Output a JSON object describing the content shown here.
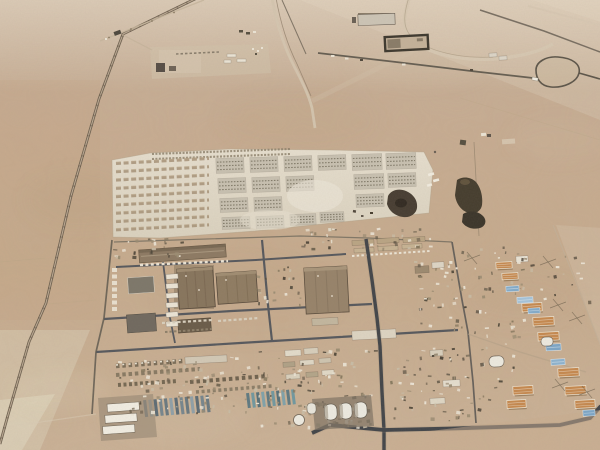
{
  "meta": {
    "type": "aerial-photograph",
    "subject": "Oblique aerial view of a large desert military base: tent city grid, warehouse district, vehicle and container yards, dome tents and rows of sand-colored barracks in flat tan desert",
    "environment": "hazy daylight over flat sandy desert",
    "visible_text": "none"
  },
  "palette": {
    "desert_top": "#c6b09a",
    "desert_mid": "#c8ad90",
    "desert_low": "#cbb297",
    "desert_light_wash": "#dccfb8",
    "tent_ground_a": "#e8e1d2",
    "tent_ground_b": "#dcd4c2",
    "tent_block": "#c8c1b1",
    "tent_speckle": "#77705f",
    "tent_row_brown": "#9b8468",
    "road_dark": "#43454a",
    "road_mid": "#56585d",
    "road_pale": "#d7c8b2",
    "track_tan": "#b3a186",
    "warehouse_roof": "#87745d",
    "warehouse_roof_light": "#97836a",
    "warehouse_long": "#8d7a63",
    "building_gray": "#7d776b",
    "building_dark": "#6b5c4a",
    "hut_white": "#ece5d6",
    "barracks_tan": "#c6894f",
    "barracks_trim": "#f0e7d5",
    "tarp_blue": "#83accb",
    "container_steel": "#6a7980",
    "container_teal": "#5e7a82",
    "scrap_dark": "#443c2f",
    "scrap_deep": "#2e2921",
    "shadow_dark": "#4f473a",
    "compound_wall": "#3e382e"
  },
  "scene": {
    "background": "open desert plain",
    "features": [
      {
        "name": "perimeter-road-west",
        "kind": "road"
      },
      {
        "name": "access-road-north",
        "kind": "road"
      },
      {
        "name": "racetrack-curve-road",
        "kind": "road"
      },
      {
        "name": "walled-compound",
        "kind": "compound"
      },
      {
        "name": "north-facility",
        "kind": "facility"
      },
      {
        "name": "tent-city-grid",
        "kind": "camp"
      },
      {
        "name": "scrap-piles",
        "kind": "debris"
      },
      {
        "name": "warehouse-district",
        "kind": "buildings"
      },
      {
        "name": "vehicle-yards",
        "kind": "storage"
      },
      {
        "name": "container-rows",
        "kind": "storage"
      },
      {
        "name": "dome-tents",
        "kind": "tents"
      },
      {
        "name": "barracks-rows",
        "kind": "buildings"
      },
      {
        "name": "blue-tarps",
        "kind": "covers"
      },
      {
        "name": "main-road-south",
        "kind": "road"
      },
      {
        "name": "main-road-east",
        "kind": "road"
      }
    ]
  }
}
